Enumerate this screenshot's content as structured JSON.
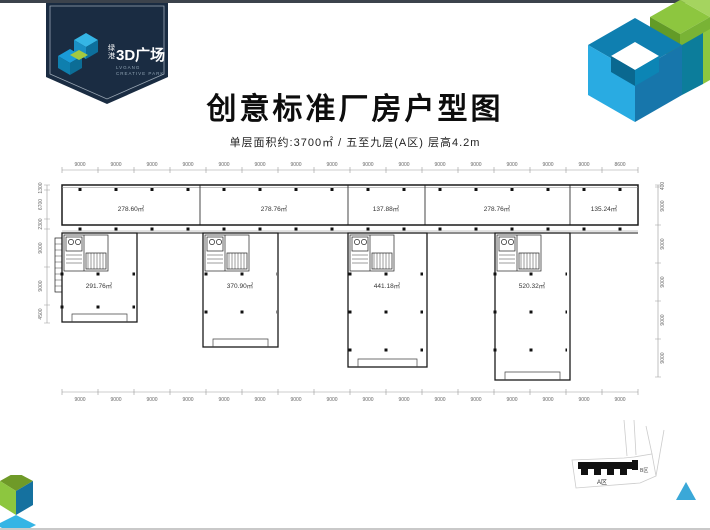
{
  "logo": {
    "cn_small_1": "绿",
    "cn_small_2": "港",
    "cn_large": "3D广场",
    "en_line1": "LVGANG",
    "en_line2": "CREATIVE PARK"
  },
  "header": {
    "title": "创意标准厂房户型图",
    "subtitle": "单层面积约:3700㎡ / 五至九层(A区) 层高4.2m"
  },
  "floorplan": {
    "dims_top": [
      "9000",
      "9000",
      "9000",
      "9000",
      "9000",
      "9000",
      "9000",
      "9000",
      "9000",
      "9000",
      "9000",
      "9000",
      "9000",
      "9000",
      "9000",
      "8600"
    ],
    "dims_bottom": [
      "9000",
      "9000",
      "9000",
      "9000",
      "9000",
      "9000",
      "9000",
      "9000",
      "9000",
      "9000",
      "9000",
      "9000",
      "9000",
      "9000",
      "9000",
      "9000"
    ],
    "dims_left": [
      "1300",
      "6700",
      "2300",
      "9000",
      "9000",
      "4500"
    ],
    "dims_right": [
      "400",
      "9000",
      "9000",
      "9000",
      "9000",
      "9000"
    ],
    "areas_top": [
      "278.60㎡",
      "278.76㎡",
      "137.88㎡",
      "278.76㎡",
      "135.24㎡"
    ],
    "areas_wings": [
      "291.76㎡",
      "370.90㎡",
      "441.18㎡",
      "520.32㎡"
    ]
  },
  "keyplan": {
    "zone_a": "A区",
    "zone_b": "B区"
  },
  "colors": {
    "navy": "#1a2c42",
    "light_blue": "#29abe2",
    "teal_blue": "#0f7fb0",
    "green": "#8dc63f",
    "north_arrow": "#3aa8d8"
  }
}
